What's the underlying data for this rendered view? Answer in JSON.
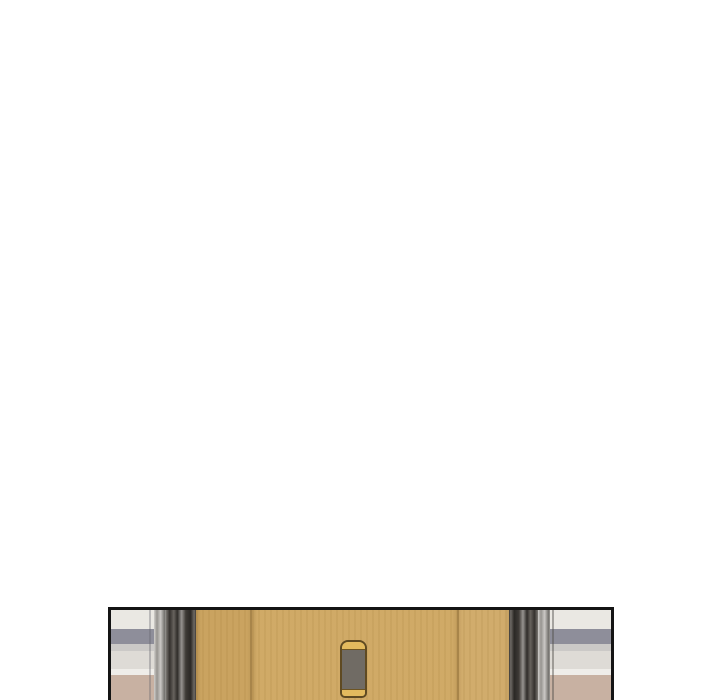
{
  "scene": {
    "kind": "webtoon-panel-top-edge",
    "page_background": "#ffffff",
    "panel_border": "#141414",
    "door": {
      "wood_center": "#cfa863",
      "wood_leaf_left": "#c9a15c",
      "wood_leaf_right": "#d0aa68",
      "seam": "#a8854a",
      "frame_metal_dark": "#56514b",
      "mullion_metal_light": "#b7b4af"
    },
    "plate": {
      "cap_gold": "#e3ba5e",
      "edge_brown": "#5f4a22",
      "screen_gray": "#706b64"
    },
    "window_bands": {
      "wall_upper": "#eae8e3",
      "rail_gray_blue": "#8e8e9a",
      "shadow_light": "#cbc9c7",
      "wall_lower": "#dedbd6",
      "baseboard_white": "#efede9",
      "floor_beige": "#c8b1a2"
    }
  }
}
